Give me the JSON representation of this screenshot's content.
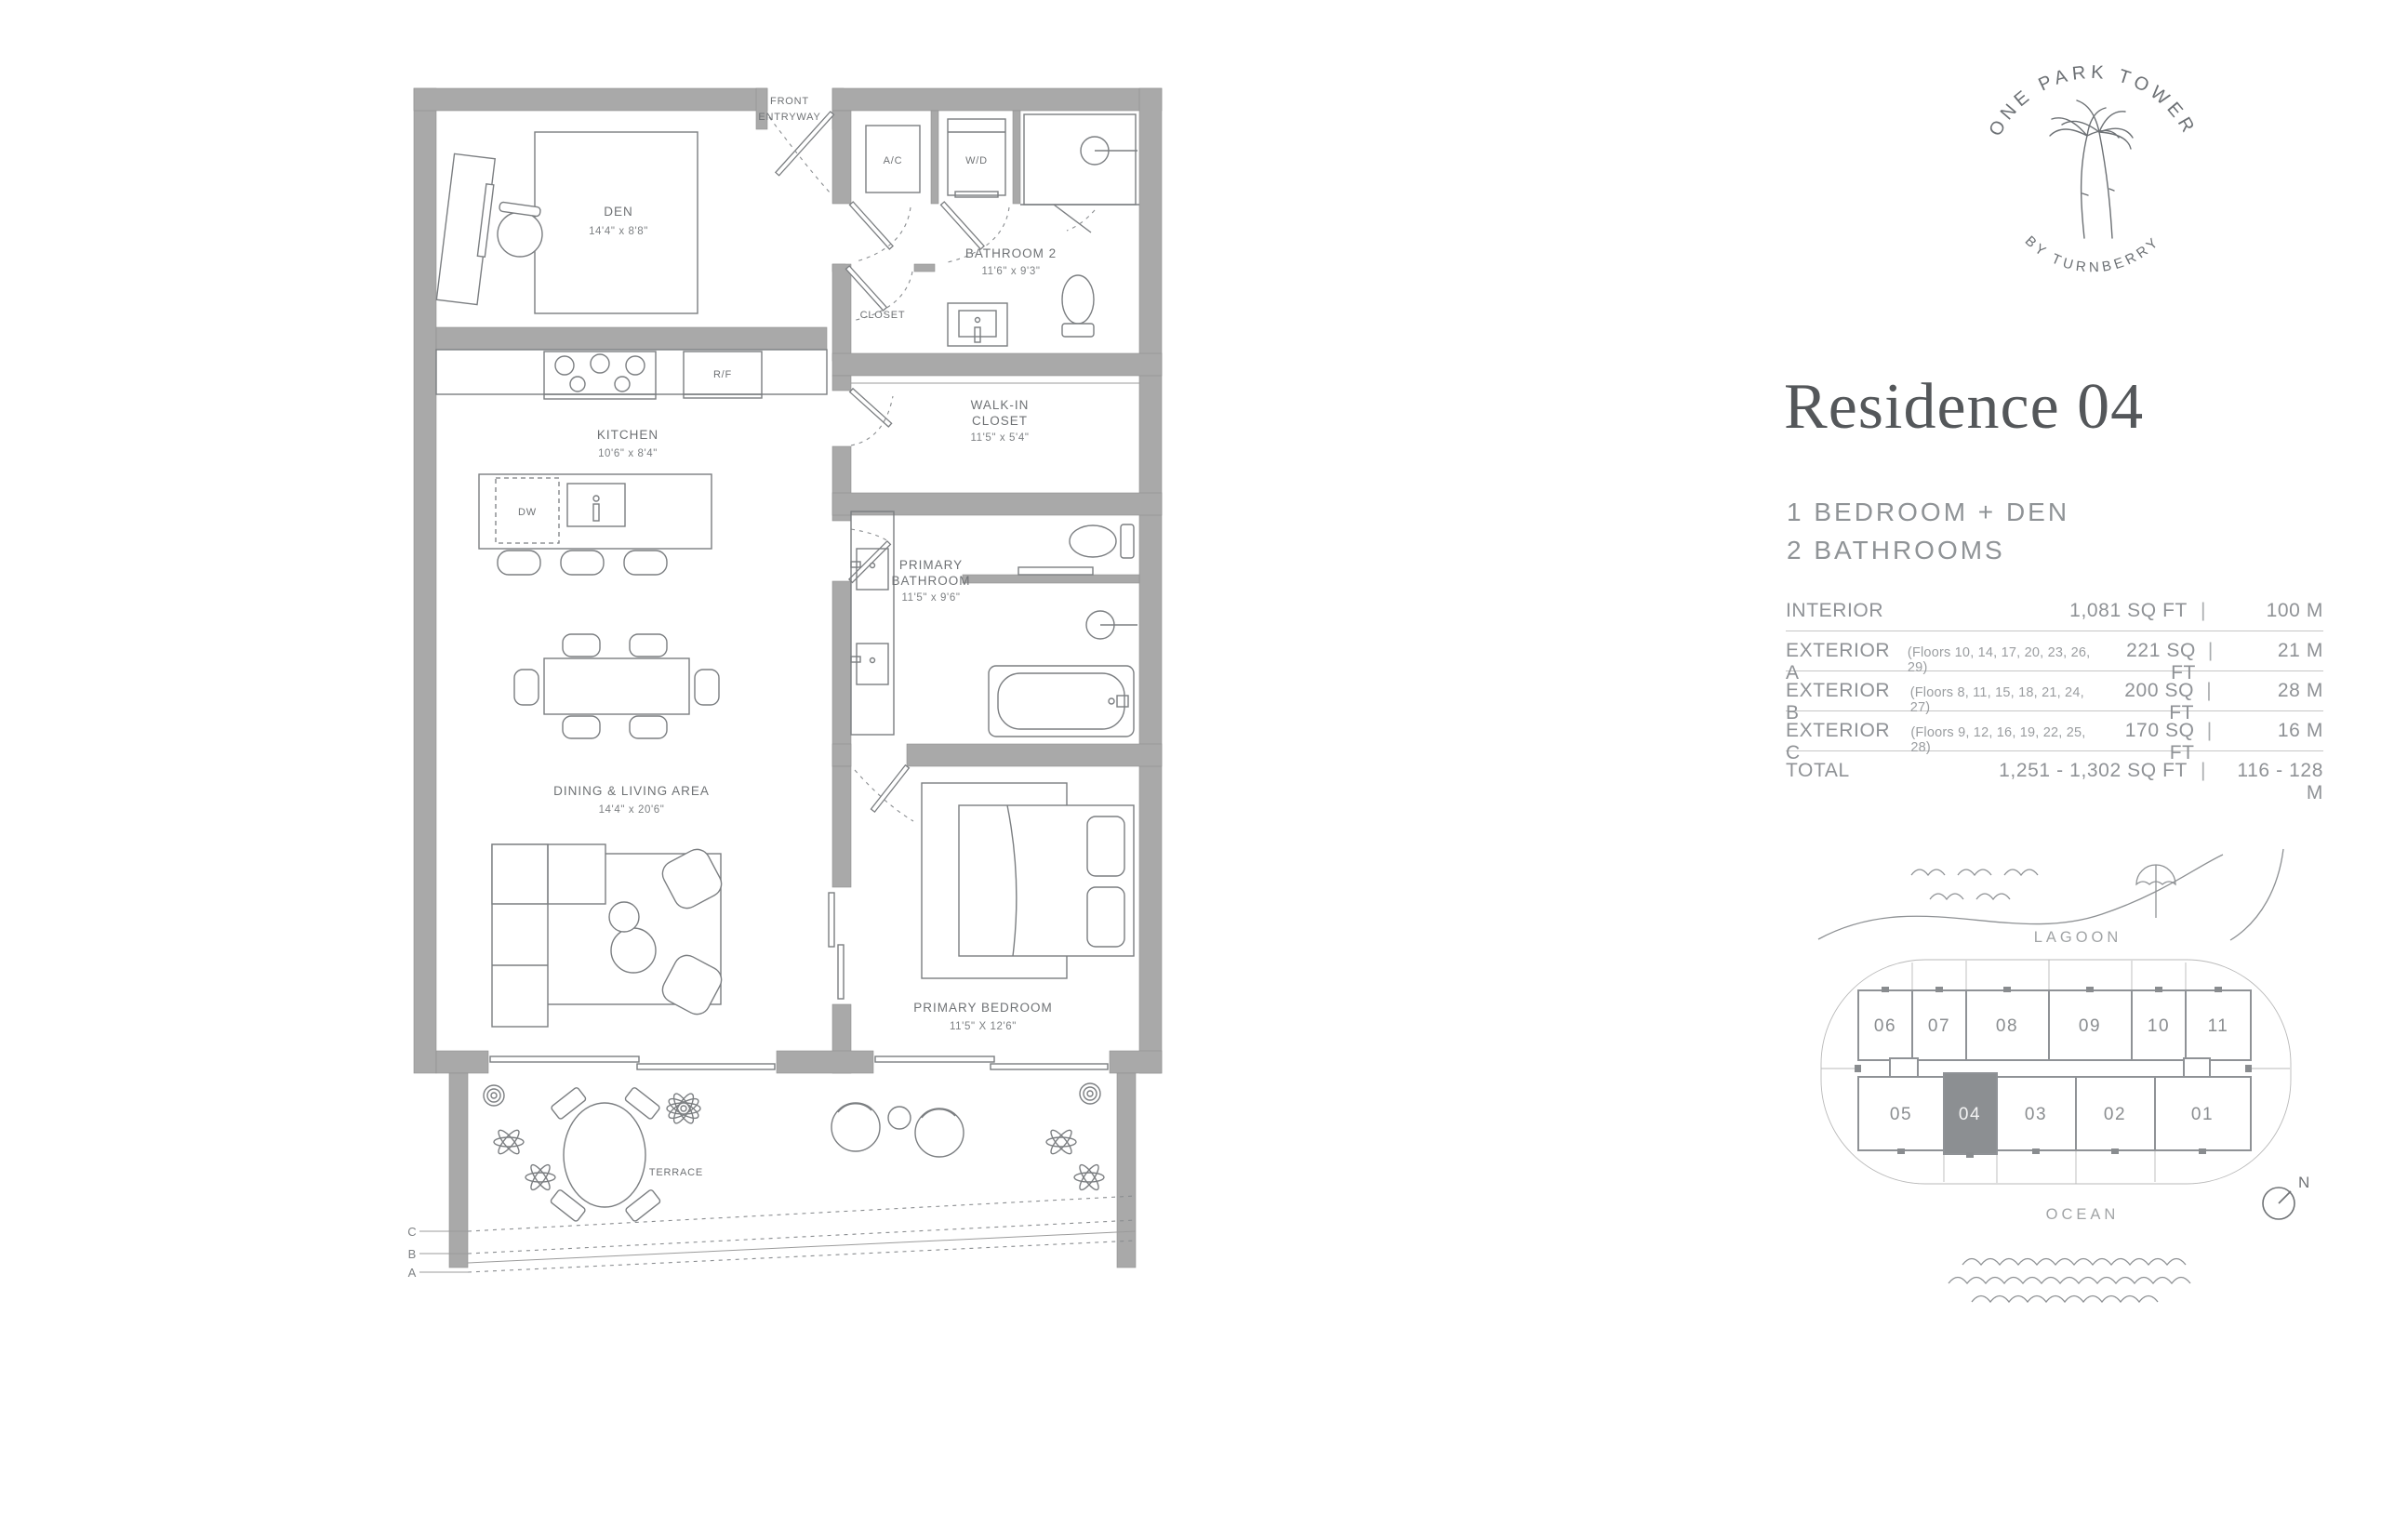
{
  "logo": {
    "top_text": "ONE PARK TOWER",
    "bottom_text": "BY TURNBERRY"
  },
  "residence": {
    "title": "Residence 04",
    "line1": "1 BEDROOM + DEN",
    "line2": "2 BATHROOMS"
  },
  "area_table": {
    "rows": [
      {
        "label": "INTERIOR",
        "note": "",
        "sqft": "1,081 SQ FT",
        "sep": "|",
        "m": "100 M"
      },
      {
        "label": "EXTERIOR A",
        "note": "(Floors 10, 14, 17, 20, 23, 26, 29)",
        "sqft": "221 SQ FT",
        "sep": "|",
        "m": "21 M"
      },
      {
        "label": "EXTERIOR B",
        "note": "(Floors 8, 11, 15, 18, 21, 24, 27)",
        "sqft": "200 SQ FT",
        "sep": "|",
        "m": "28 M"
      },
      {
        "label": "EXTERIOR C",
        "note": "(Floors 9, 12, 16, 19, 22, 25, 28)",
        "sqft": "170 SQ FT",
        "sep": "|",
        "m": "16 M"
      },
      {
        "label": "TOTAL",
        "note": "",
        "sqft": "1,251 - 1,302 SQ FT",
        "sep": "|",
        "m": "116 - 128 M"
      }
    ]
  },
  "keyplan": {
    "lagoon": "LAGOON",
    "ocean": "OCEAN",
    "north": "N",
    "top_units": [
      "06",
      "07",
      "08",
      "09",
      "10",
      "11"
    ],
    "bottom_units": [
      "05",
      "04",
      "03",
      "02",
      "01"
    ],
    "highlighted_unit": "04"
  },
  "floorplan": {
    "entry": [
      "FRONT",
      "ENTRYWAY"
    ],
    "rooms": {
      "den": {
        "name": "DEN",
        "dims": "14'4\" x 8'8\""
      },
      "kitchen": {
        "name": "KITCHEN",
        "dims": "10'6\" x 8'4\""
      },
      "bathroom2": {
        "name": "BATHROOM 2",
        "dims": "11'6\" x 9'3\""
      },
      "walkin": {
        "l1": "WALK-IN",
        "l2": "CLOSET",
        "dims": "11'5\" x 5'4\""
      },
      "primary_bath": {
        "l1": "PRIMARY",
        "l2": "BATHROOM",
        "dims": "11'5\" x 9'6\""
      },
      "dining": {
        "name": "DINING & LIVING AREA",
        "dims": "14'4\" x 20'6\""
      },
      "bedroom": {
        "name": "PRIMARY BEDROOM",
        "dims": "11'5\" X 12'6\""
      },
      "terrace": {
        "name": "TERRACE"
      }
    },
    "fixtures": {
      "ac": "A/C",
      "wd": "W/D",
      "rf": "R/F",
      "dw": "DW",
      "closet": "CLOSET"
    },
    "markers": [
      "C",
      "B",
      "A"
    ]
  },
  "colors": {
    "wall": "#a9a9a9",
    "line": "#7b7e81",
    "text": "#8f9296",
    "highlight": "#8c8f92"
  }
}
